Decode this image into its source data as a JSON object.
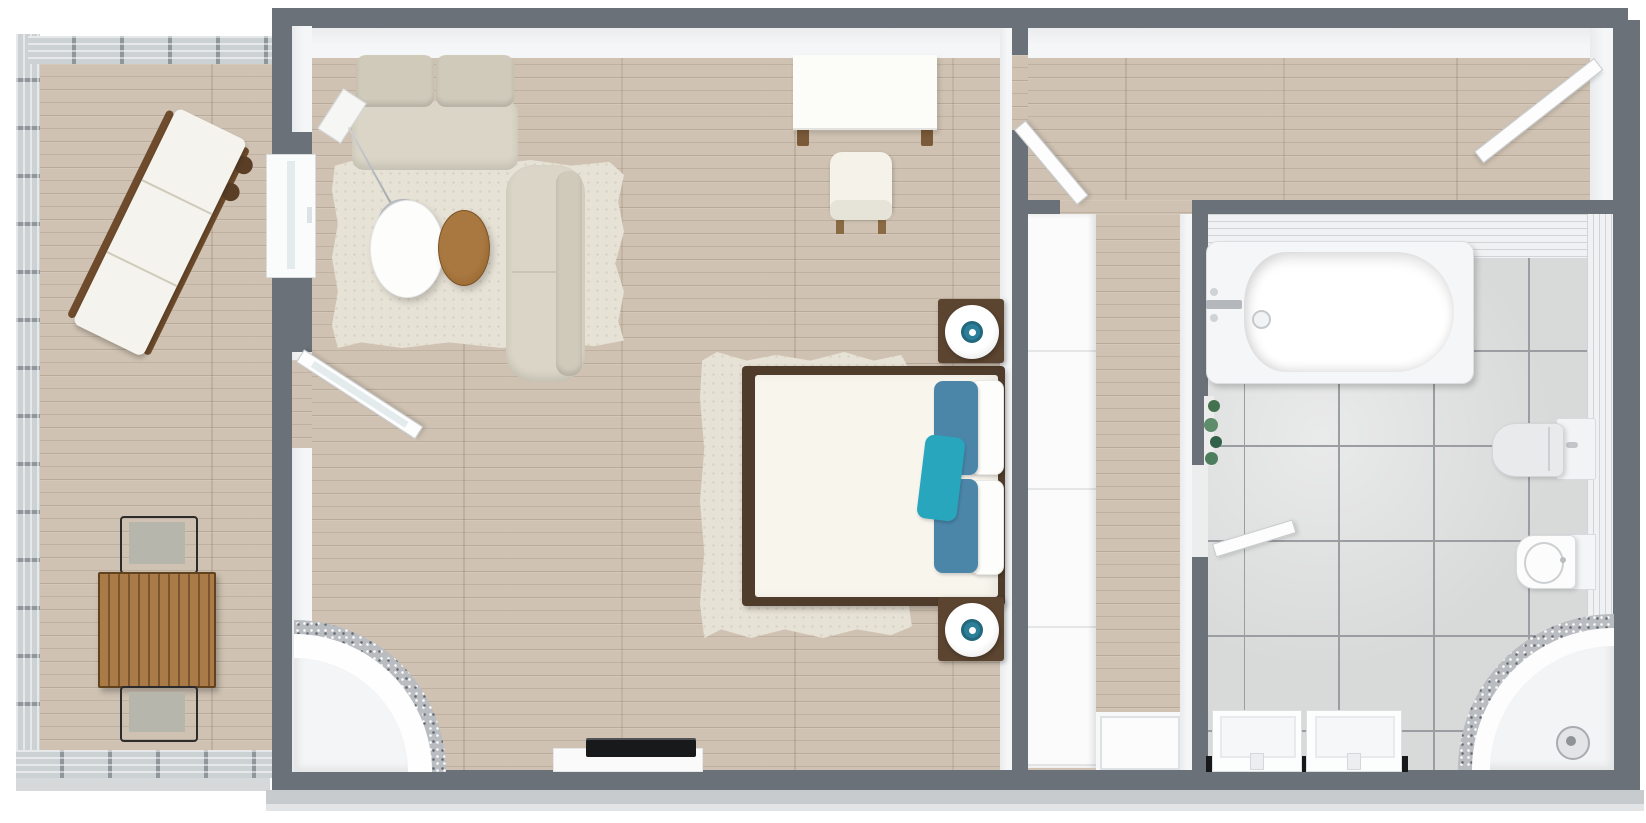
{
  "palette": {
    "wall": "#6b7178",
    "wallFace": "#f5f6f7",
    "wood": "#cfc2b2",
    "tile": "#d8d9d9",
    "grout": "#9a9ea2",
    "rug": "#e7e2d6",
    "sofa": "#dad5c6",
    "sofaShade": "#d0cabb",
    "mattress": "#f8f5ed",
    "bedFrame": "#4f3c2a",
    "pillowBlue": "#4b86a9",
    "pillowTeal": "#27a6bd",
    "nightstand": "#5b4430",
    "lampTeal": "#2b7f98",
    "tableWood": "#9c6c35",
    "deckWood": "#aa7b46",
    "chairFrame": "#2c2c2c",
    "chairFabric": "#b7b6ad",
    "railing": "#ccd1d4",
    "railingPost": "#8f969c",
    "slab": "#c8cbce",
    "chrome": "#b9bdc1",
    "tvBlack": "#17191b",
    "counterBlack": "#17181a",
    "plantGreen": "#4c7e5e",
    "glass": "#e3ebed"
  },
  "rooms": [
    {
      "name": "balcony",
      "furniture": [
        "glass-railing",
        "sun-lounger",
        "outdoor-dining-table",
        "outdoor-chair",
        "outdoor-chair"
      ]
    },
    {
      "name": "living-bedroom",
      "furniture": [
        "sofa",
        "chaise-sofa",
        "area-rug",
        "arc-floor-lamp",
        "oval-coffee-table",
        "wood-side-table",
        "console-desk",
        "armchair",
        "double-bed",
        "bed-rug",
        "nightstand-with-lamp",
        "nightstand-with-lamp",
        "tv-console",
        "tv",
        "corner-shower",
        "window",
        "balcony-door"
      ]
    },
    {
      "name": "inner-room",
      "furniture": [
        "door",
        "door"
      ]
    },
    {
      "name": "hallway",
      "furniture": [
        "wardrobe",
        "entry-door"
      ]
    },
    {
      "name": "bathroom",
      "furniture": [
        "bathtub",
        "faucet",
        "plant",
        "toilet",
        "bidet",
        "corner-shower",
        "shower-head",
        "vanity-counter",
        "sink",
        "sink",
        "door"
      ]
    }
  ]
}
